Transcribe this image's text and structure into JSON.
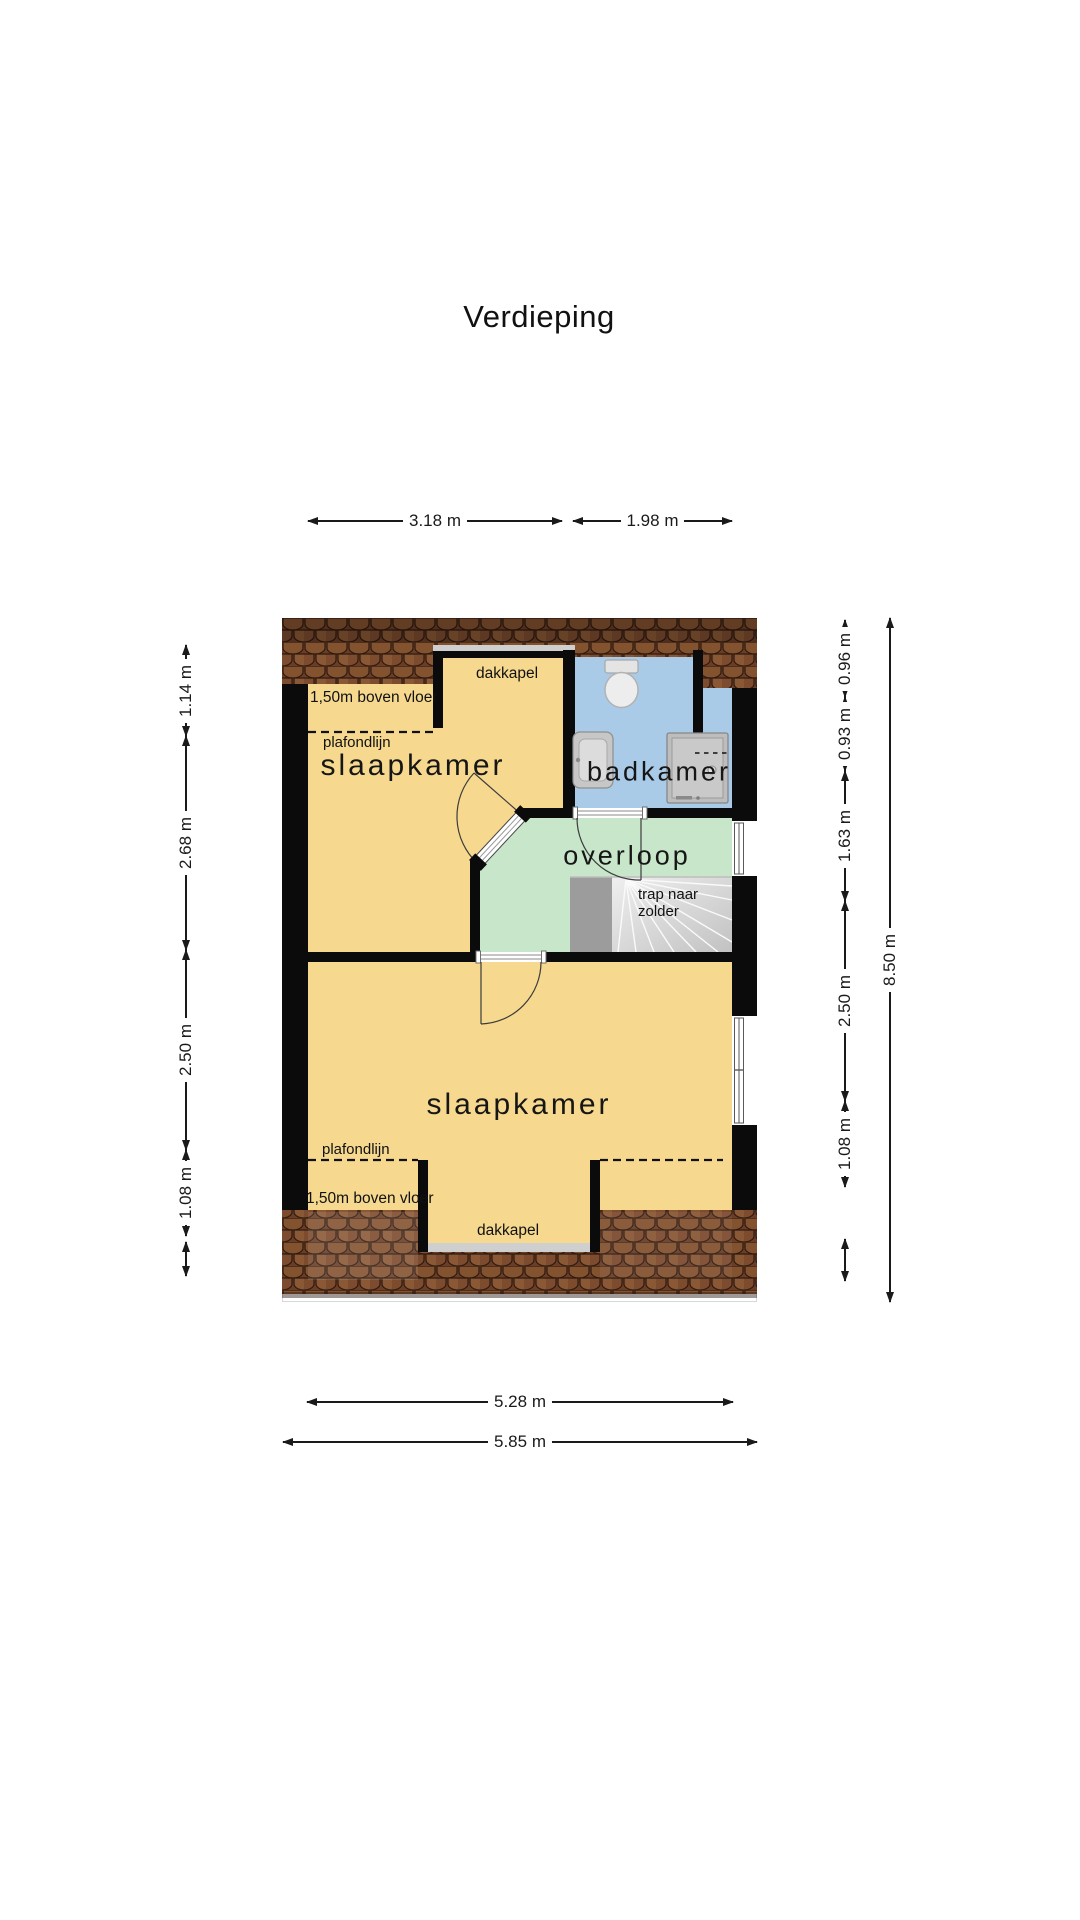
{
  "title": "Verdieping",
  "rooms": {
    "bedroom_top": "slaapkamer",
    "bathroom": "badkamer",
    "landing": "overloop",
    "bedroom_bottom": "slaapkamer",
    "stairs_line1": "trap naar",
    "stairs_line2": "zolder"
  },
  "annotations": {
    "dormer_top": "dakkapel",
    "dormer_bottom": "dakkapel",
    "ceiling_line_top": "plafondlijn",
    "ceiling_line_bottom": "plafondlijn",
    "height_note_top": "1,50m boven vloer",
    "height_note_bottom": "1,50m boven vloer"
  },
  "dimensions": {
    "top": [
      "3.18 m",
      "1.98 m"
    ],
    "bottom": [
      "5.28 m",
      "5.85 m"
    ],
    "left": [
      "1.14 m",
      "2.68 m",
      "2.50 m",
      "1.08 m"
    ],
    "right": [
      "0.96 m",
      "0.93 m",
      "1.63 m",
      "2.50 m",
      "1.08 m"
    ],
    "total_height": "8.50 m"
  },
  "fixtures": [
    "toilet",
    "washbasin",
    "shower",
    "staircase"
  ],
  "colors": {
    "room_yellow": "#f6d98f",
    "bathroom_blue": "#a9cbe8",
    "landing_green": "#c8e6c9",
    "roof_brown": "#7b4930",
    "wall_black": "#0b0b0b"
  }
}
